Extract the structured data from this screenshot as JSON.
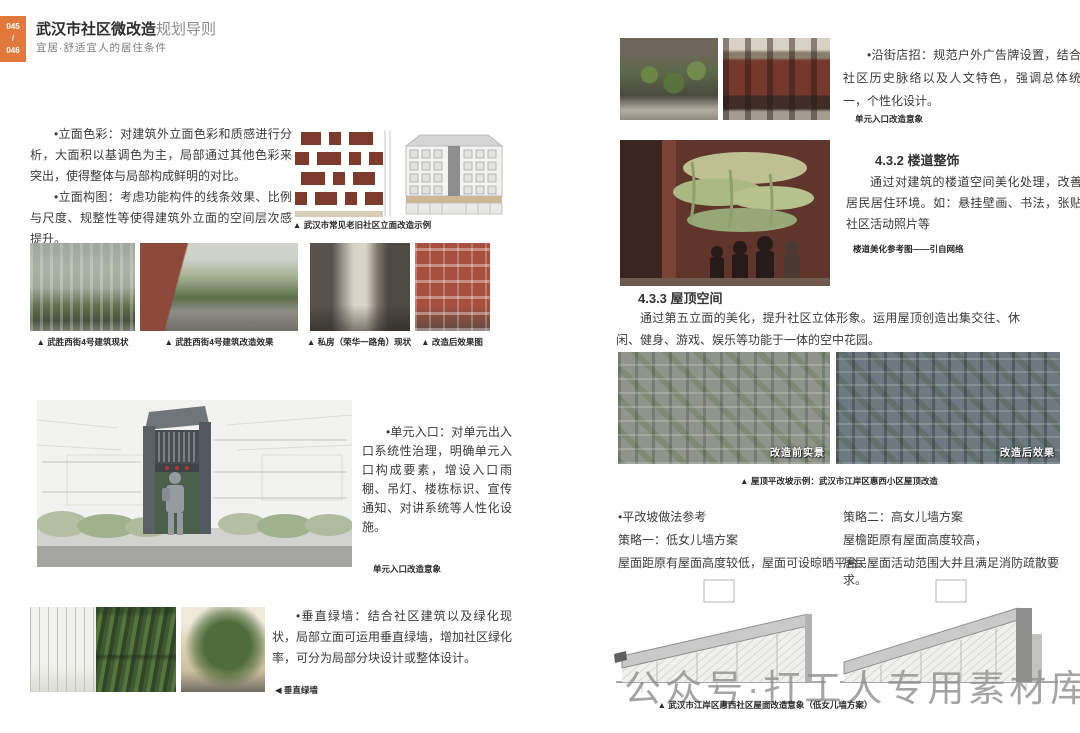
{
  "header": {
    "page_number_top": "045",
    "page_number_sep": "/",
    "page_number_bottom": "046",
    "title_strong": "武汉市社区微改造",
    "title_rest": "规划导则",
    "subtitle": "宜居·舒适宜人的居住条件"
  },
  "left_page": {
    "para_facade_color": "•立面色彩：对建筑外立面色彩和质感进行分析，大面积以基调色为主，局部通过其他色彩来突出，使得整体与局部构成鲜明的对比。",
    "para_facade_comp": "•立面构图：考虑功能构件的线条效果、比例与尺度、规整性等使得建筑外立面的空间层次感提升。",
    "elevation_caption": "▲ 武汉市常见老旧社区立面改造示例",
    "photo_captions": [
      "▲ 武胜西街4号建筑现状",
      "▲ 武胜西街4号建筑改造效果",
      "▲ 私房（荣华一路角）现状",
      "▲ 改造后效果图"
    ],
    "para_entrance": "•单元入口：对单元出入口系统性治理，明确单元入口构成要素，增设入口雨棚、吊灯、楼栋标识、宣传通知、对讲系统等人性化设施。",
    "entrance_caption": "单元入口改造意象",
    "para_greenwall": "•垂直绿墙：结合社区建筑以及绿化现状，局部立面可运用垂直绿墙，增加社区绿化率，可分为局部分块设计或整体设计。",
    "greenwall_caption": "◀ 垂直绿墙"
  },
  "right_page": {
    "para_shopsign": "•沿街店招：规范户外广告牌设置，结合社区历史脉络以及人文特色，强调总体统一，个性化设计。",
    "shopsign_caption": "单元入口改造意象",
    "s432_heading": "4.3.2 楼道整饰",
    "s432_body": "通过对建筑的楼道空间美化处理，改善居民居住环境。如：悬挂壁画、书法，张贴社区活动照片等",
    "s432_caption": "楼道美化参考图——引自网络",
    "s433_heading": "4.3.3 屋顶空间",
    "s433_body": "通过第五立面的美化，提升社区立体形象。运用屋顶创造出集交往、休闲、健身、游戏、娱乐等功能于一体的空中花园。",
    "aerial_label_before": "改造前实景",
    "aerial_label_after": "改造后效果",
    "aerial_caption": "▲ 屋顶平改坡示例：武汉市江岸区惠西小区屋顶改造",
    "pitch_ref_title": "•平改坡做法参考",
    "strategy1_title": "策略一：低女儿墙方案",
    "strategy1_desc": "屋面距原有屋面高度较低，屋面可设晾晒平台。",
    "strategy2_title": "策略二：高女儿墙方案",
    "strategy2_desc_1": "屋檐距原有屋面高度较高，",
    "strategy2_desc_2": "居民屋面活动范围大并且满足消防疏散要求。",
    "roof_caption": "▲ 武汉市江岸区惠西社区屋面改造意象（低女儿墙方案）"
  },
  "watermark": {
    "icon": "wechat-icon",
    "text": "公众号·打工人专用素材库"
  },
  "colors": {
    "accent_orange": "#E2783C",
    "text_dark": "#3b3b3b",
    "watermark_gray": "#8f8f8f"
  }
}
